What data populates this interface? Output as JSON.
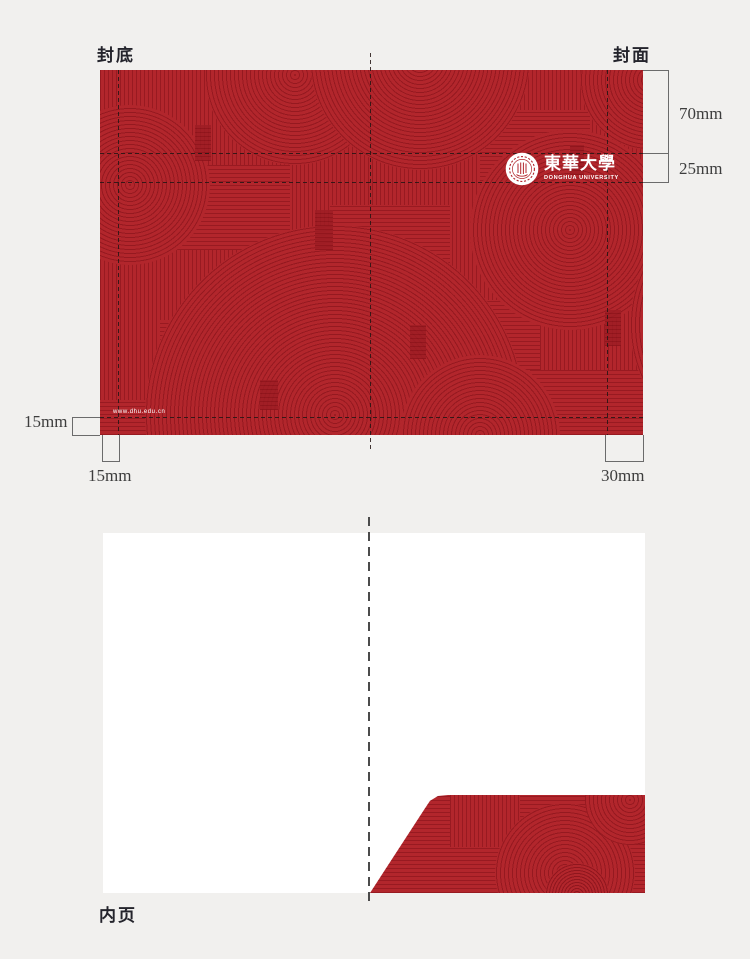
{
  "colors": {
    "background": "#f1f0ee",
    "cover_red": "#b2262c",
    "pattern_line_red": "#9a1c23",
    "page_white": "#ffffff",
    "guide_line": "#231614",
    "bracket_gray": "#6b6b6b",
    "label_dark": "#24242c"
  },
  "cover_spread": {
    "back_cover_label": "封底",
    "front_cover_label": "封面",
    "logo": {
      "seal_icon": "donghua-university-seal",
      "name_cn": "東華大學",
      "name_en": "DONGHUA UNIVERSITY"
    },
    "website_url": "www.dhu.edu.cn"
  },
  "measurements": {
    "front_top_height": "70mm",
    "logo_band_height": "25mm",
    "left_side_bottom_margin": "15mm",
    "bottom_left_margin": "15mm",
    "bottom_right_margin": "30mm"
  },
  "inner_page": {
    "label": "内页"
  }
}
